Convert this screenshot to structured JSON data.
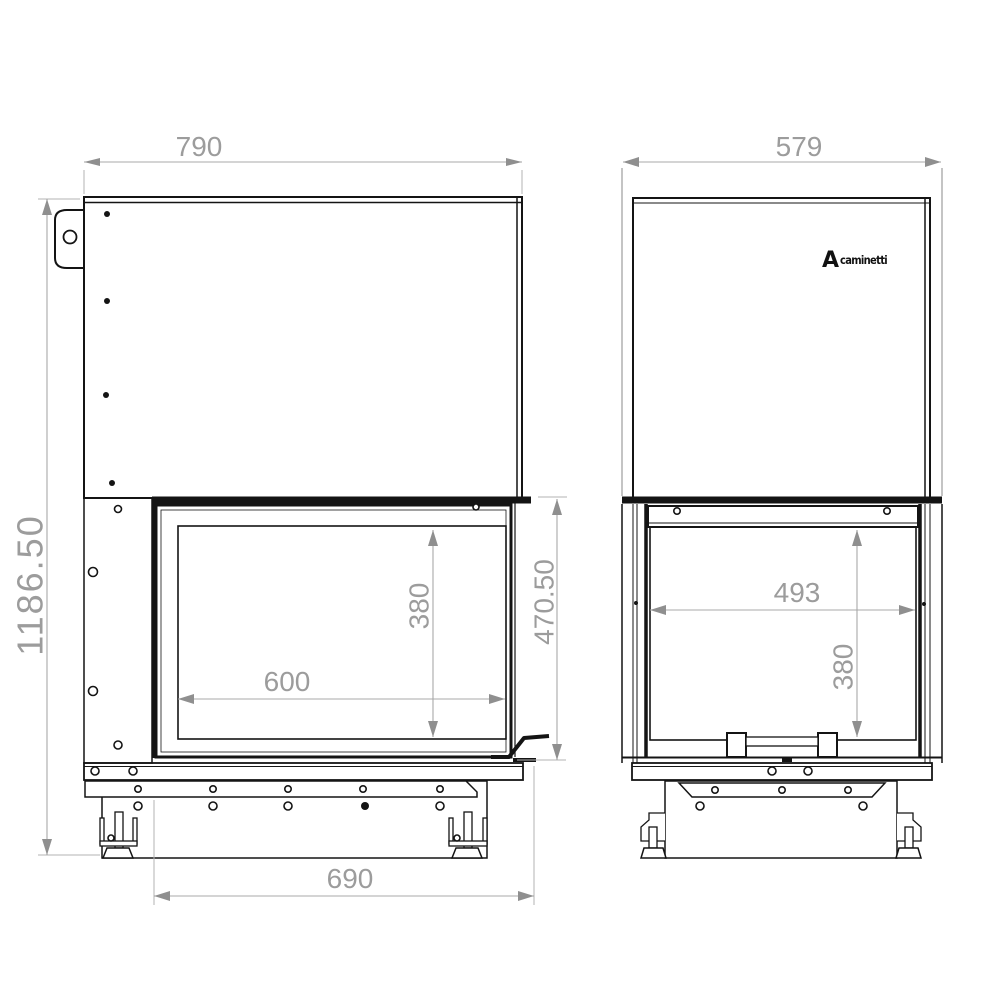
{
  "drawing": {
    "type": "technical-drawing",
    "subject": "fireplace insert front and side elevation",
    "background": "#ffffff"
  },
  "dimensions": {
    "front_overall_width": "790",
    "overall_height": "1186.50",
    "door_opening_width": "600",
    "door_opening_height": "380",
    "firebox_front_height": "470.50",
    "base_width": "690",
    "side_overall_width": "579",
    "side_opening_width": "493",
    "side_opening_height": "380"
  },
  "logo": {
    "letter": "A",
    "wordmark": "caminetti"
  },
  "colors": {
    "line": "#141414",
    "dimension_gray": "#9c9c9c",
    "background": "#ffffff",
    "logo": "#111111"
  }
}
